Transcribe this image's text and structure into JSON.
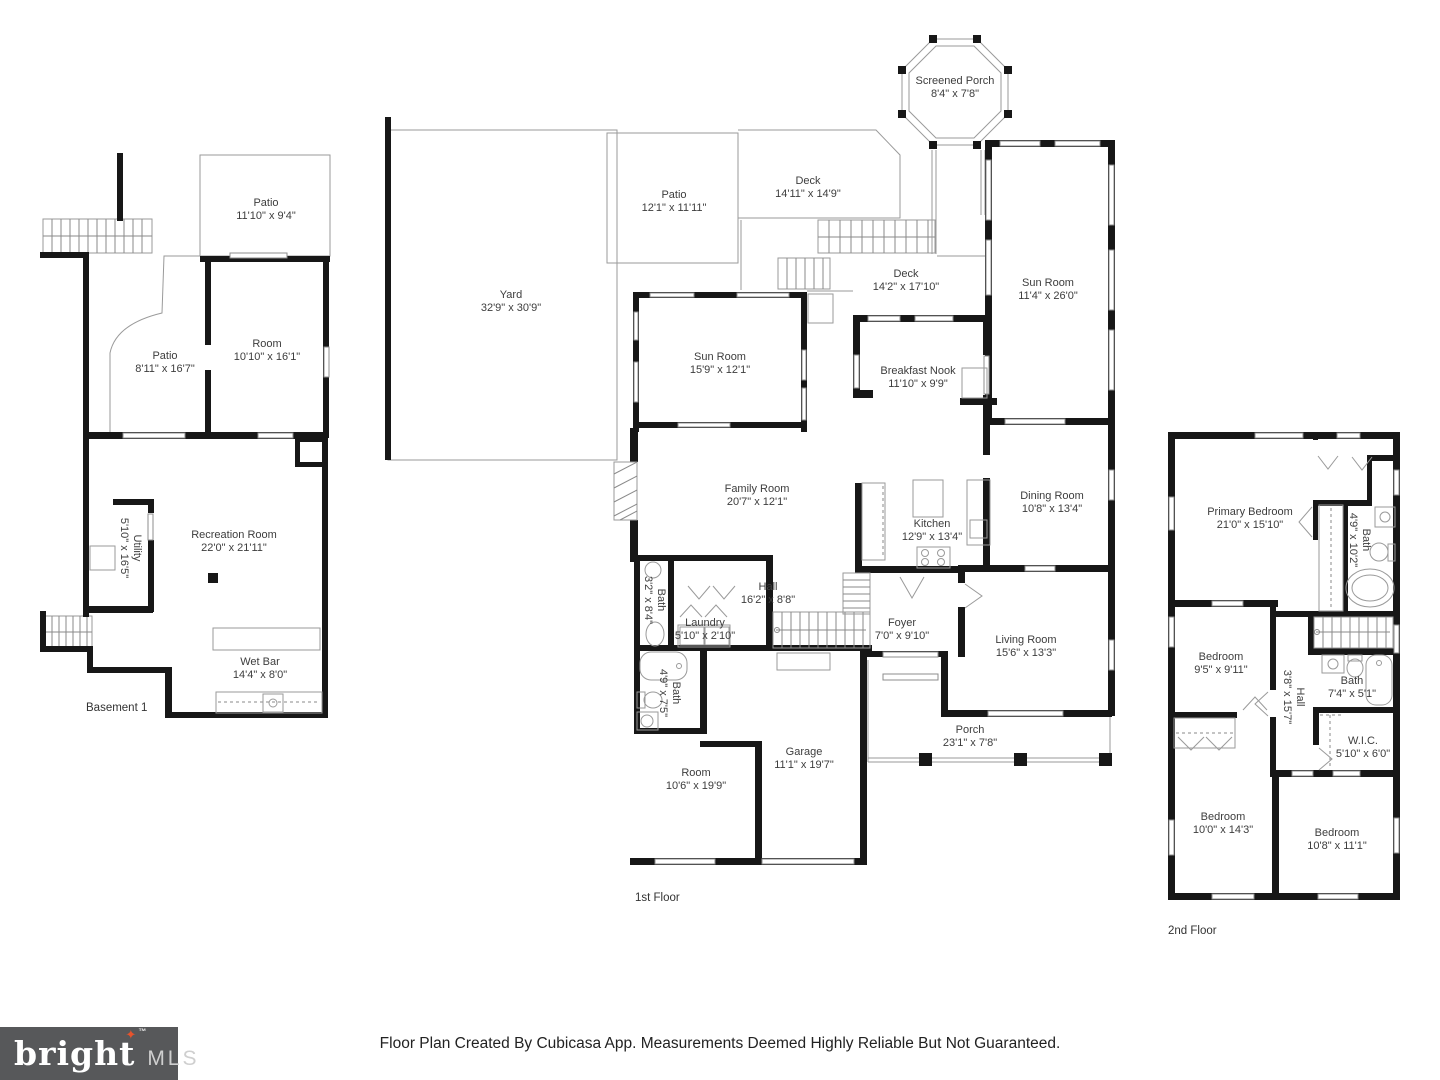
{
  "colors": {
    "wall": "#171717",
    "thin_line": "#9a9a9a",
    "label_text": "#3d3d3d",
    "logo_background": "#57585a",
    "logo_star": "#e8532c",
    "logo_brand_text": "#ffffff",
    "logo_mls_text": "#cfcfcf"
  },
  "footer": {
    "disclaimer": "Floor Plan Created By Cubicasa App. Measurements Deemed Highly Reliable But Not Guaranteed.",
    "logo": {
      "brand": "bright",
      "tm": "™",
      "star": "✦",
      "suffix": "MLS"
    }
  },
  "floors": {
    "basement": {
      "title": "Basement 1",
      "rooms": {
        "patio_top": {
          "name": "Patio",
          "dims": "11'10\" x 9'4\""
        },
        "room": {
          "name": "Room",
          "dims": "10'10\" x 16'1\""
        },
        "patio_left": {
          "name": "Patio",
          "dims": "8'11\" x 16'7\""
        },
        "recreation": {
          "name": "Recreation Room",
          "dims": "22'0\" x 21'11\""
        },
        "utility": {
          "name": "Utility",
          "dims": "5'10\" x 16'5\""
        },
        "wet_bar": {
          "name": "Wet Bar",
          "dims": "14'4\" x 8'0\""
        }
      }
    },
    "first": {
      "title": "1st Floor",
      "rooms": {
        "screened_porch": {
          "name": "Screened Porch",
          "dims": "8'4\" x 7'8\""
        },
        "yard": {
          "name": "Yard",
          "dims": "32'9\" x 30'9\""
        },
        "patio": {
          "name": "Patio",
          "dims": "12'1\" x 11'11\""
        },
        "deck_upper": {
          "name": "Deck",
          "dims": "14'11\" x 14'9\""
        },
        "deck_lower": {
          "name": "Deck",
          "dims": "14'2\" x 17'10\""
        },
        "sun_room_right": {
          "name": "Sun Room",
          "dims": "11'4\" x 26'0\""
        },
        "sun_room": {
          "name": "Sun Room",
          "dims": "15'9\" x 12'1\""
        },
        "breakfast_nook": {
          "name": "Breakfast Nook",
          "dims": "11'10\" x 9'9\""
        },
        "family_room": {
          "name": "Family Room",
          "dims": "20'7\" x 12'1\""
        },
        "kitchen": {
          "name": "Kitchen",
          "dims": "12'9\" x 13'4\""
        },
        "dining_room": {
          "name": "Dining Room",
          "dims": "10'8\" x 13'4\""
        },
        "hall": {
          "name": "Hall",
          "dims": "16'2\" x 8'8\""
        },
        "bath_small": {
          "name": "Bath",
          "dims": "3'2\" x 8'4\""
        },
        "laundry": {
          "name": "Laundry",
          "dims": "5'10\" x 2'10\""
        },
        "foyer": {
          "name": "Foyer",
          "dims": "7'0\" x 9'10\""
        },
        "living_room": {
          "name": "Living Room",
          "dims": "15'6\" x 13'3\""
        },
        "bath": {
          "name": "Bath",
          "dims": "4'9\" x 7'5\""
        },
        "room": {
          "name": "Room",
          "dims": "10'6\" x 19'9\""
        },
        "garage": {
          "name": "Garage",
          "dims": "11'1\" x 19'7\""
        },
        "porch": {
          "name": "Porch",
          "dims": "23'1\" x 7'8\""
        }
      }
    },
    "second": {
      "title": "2nd Floor",
      "rooms": {
        "primary_bedroom": {
          "name": "Primary Bedroom",
          "dims": "21'0\" x 15'10\""
        },
        "bath_primary": {
          "name": "Bath",
          "dims": "4'9\" x 10'2\""
        },
        "bedroom_small": {
          "name": "Bedroom",
          "dims": "9'5\" x 9'11\""
        },
        "hall": {
          "name": "Hall",
          "dims": "3'8\" x 15'7\""
        },
        "bath": {
          "name": "Bath",
          "dims": "7'4\" x 5'1\""
        },
        "wic": {
          "name": "W.I.C.",
          "dims": "5'10\" x 6'0\""
        },
        "bedroom_left": {
          "name": "Bedroom",
          "dims": "10'0\" x 14'3\""
        },
        "bedroom_right": {
          "name": "Bedroom",
          "dims": "10'8\" x 11'1\""
        }
      }
    }
  }
}
